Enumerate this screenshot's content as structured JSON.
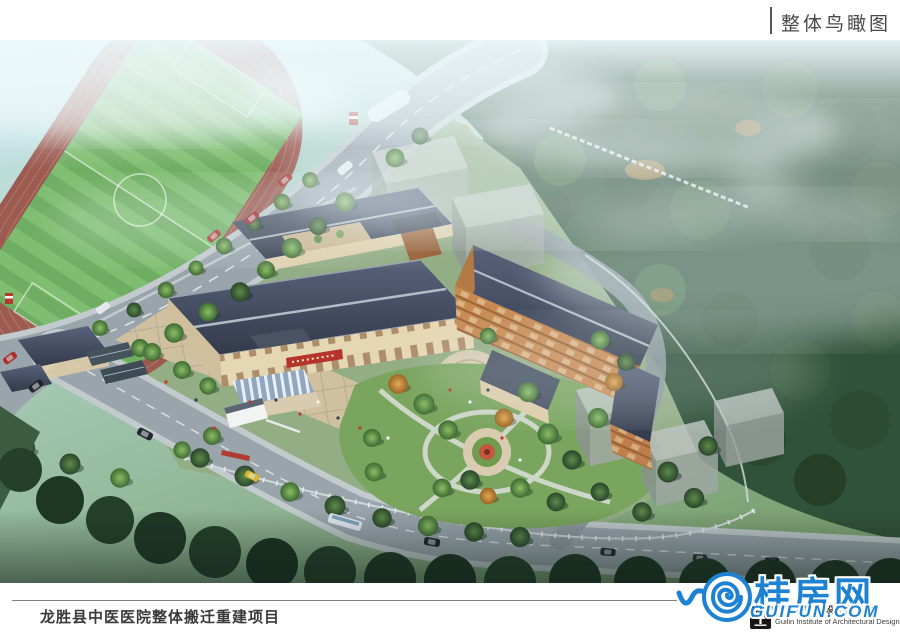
{
  "header": {
    "title": "整体鸟瞰图"
  },
  "footer": {
    "project_title": "龙胜县中医医院整体搬迁重建项目"
  },
  "watermark": {
    "site_name": "桂房网",
    "site_domain": "GUIFUN.COM",
    "color": "#1e82d2"
  },
  "designer": {
    "name_cn": "桂林市建筑设计研究院",
    "name_en": "Guilin Institute of Architectural Design"
  },
  "theme": {
    "accent_blue": "#1e82d2",
    "header_text": "#4a4a4a",
    "footer_text": "#3a3a3a"
  },
  "scene": {
    "description": "Aerial bird's-eye architectural rendering of the Longsheng County TCM Hospital relocation project: two Chinese-roofed hospital buildings with entrance plaza and landscaped garden, a running track and soccer field at upper left, tree-lined roads with cars and a bus, translucent gray massing blocks, and misty forested hills behind",
    "elements": [
      "sports-field",
      "running-track",
      "main-road",
      "bottom-road",
      "outpatient-building",
      "rear-courtyard-building",
      "inpatient-building",
      "entrance-plaza",
      "entrance-canopy",
      "entrance-sign",
      "entrance-gate",
      "garden",
      "central-flowerbed",
      "gray-massing-blocks",
      "forest",
      "mist",
      "cars",
      "bus",
      "pedestrians"
    ],
    "colors": {
      "roof_slate": "#3c4454",
      "wall_cream": "#e6d7b4",
      "wood_orange": "#c98a52",
      "track_red": "#9c5a50",
      "field_green": "#6fae62",
      "road_gray": "#99a4ab",
      "forest_green": "#2f5134",
      "sign_red": "#b5342c"
    }
  }
}
